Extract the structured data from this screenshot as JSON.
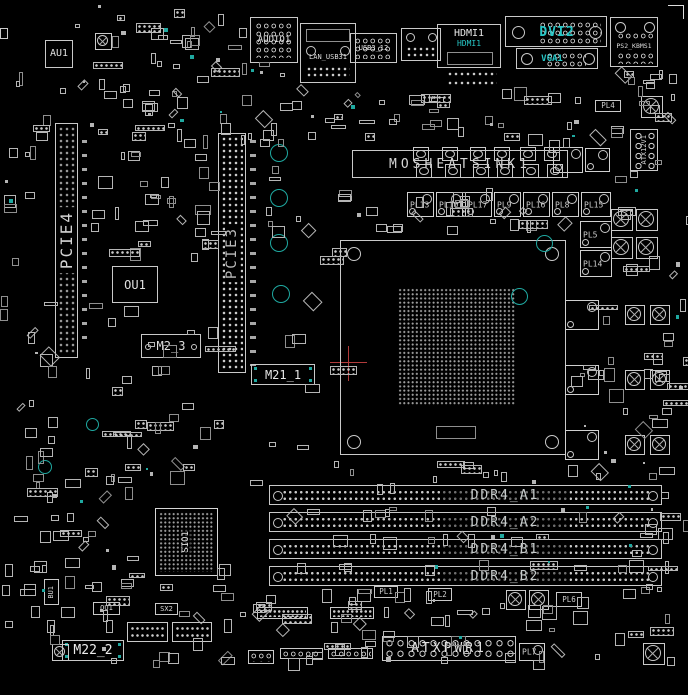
{
  "colors": {
    "line": "#c9c9c9",
    "cyan": "#27c7c7",
    "teal": "#1fa9a1",
    "red": "#b23b3b",
    "background": "#000000"
  },
  "rear_io": {
    "audio_label": "AUDIO1",
    "lan_usb_label": "LAN_USB31",
    "usb_a_label": "USB3_12",
    "hdmi_label": "HDMI1",
    "hdmi_sublabel": "HDMI1",
    "dvi_label": "DVI2",
    "vga_label": "VGA1",
    "ps2_label": "PS2_KBMS1"
  },
  "chips": {
    "au1": "AU1",
    "ou1": "OU1",
    "sio1": "SIO1",
    "bu1": "BU1",
    "ou1_small": "OU1",
    "sx2": "SX2"
  },
  "slots": {
    "pcie4": "PCIE4",
    "pcie3": "PCIE3",
    "m2_3": "M2_3",
    "m21_1": "M21_1",
    "m22_2": "M22_2"
  },
  "memory": {
    "slot_labels": [
      "DDR4_A1",
      "DDR4_A2",
      "DDR4_B1",
      "DDR4_B2"
    ]
  },
  "power": {
    "atx_label": "ATXPWR1",
    "atx12v_label": "ATX12V1",
    "heatsink_label": "MOSHEATSINK1"
  },
  "inductors": {
    "row": [
      "PL13",
      "PL10",
      "PL17",
      "PL9",
      "PL16",
      "PL8"
    ],
    "col": [
      "PL15",
      "PL5",
      "PL14"
    ],
    "misc": [
      "PL4",
      "PL1",
      "PL2",
      "PL6",
      "PL7"
    ]
  }
}
